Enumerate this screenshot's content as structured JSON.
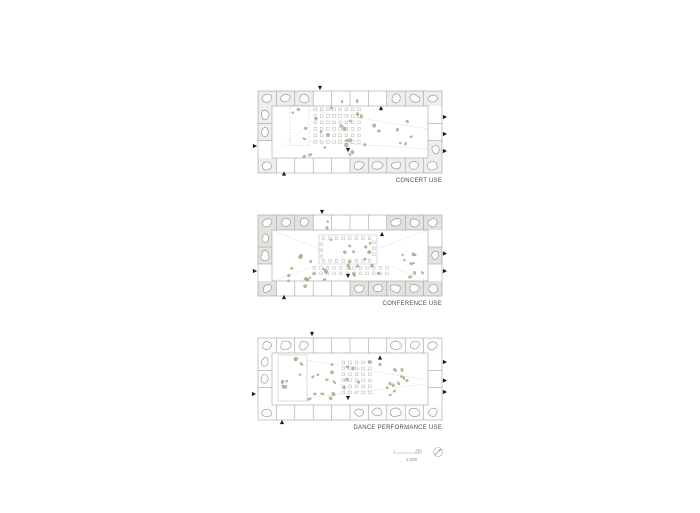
{
  "canvas": {
    "width": 700,
    "height": 513,
    "background": "#ffffff"
  },
  "colors": {
    "grid": "#9a9a9a",
    "grid_light": "#bdbdbd",
    "rock_stroke": "#8d8d8d",
    "rock_fill": "#fdfdfc",
    "figure_fill": "#b9ae8c",
    "figure_stroke": "#958b6a",
    "chair_stroke": "#aeaeae",
    "marker": "#1c1c1c",
    "label_text": "#4d4d4d",
    "sightline": "#e2e2e2",
    "footer_line": "#9f9f9f"
  },
  "plans": [
    {
      "name": "concert",
      "label": "CONCERT USE",
      "origin": {
        "x": 258,
        "y": 87
      },
      "size": {
        "w": 184,
        "h": 82
      },
      "band": {
        "top": 15,
        "bottom": 15,
        "left": 14,
        "right": 14
      },
      "top_cells": 10,
      "side_rows": 3,
      "cell_fill": "#efeeec",
      "rocks": {
        "top": [
          0,
          1,
          2,
          7,
          8,
          9
        ],
        "bottom": [
          0,
          5,
          6,
          7,
          8,
          9
        ],
        "left": [
          0,
          1
        ],
        "right": [
          2
        ]
      },
      "rects": [
        {
          "x": 32,
          "y": 14.5,
          "w": 19,
          "h": 40,
          "dash": true
        }
      ],
      "chair_grids": [
        {
          "x": 56,
          "y": 17,
          "cols": 8,
          "rows": 6,
          "dx": 6.2,
          "dy": 6.5,
          "size": 2.8
        }
      ],
      "figure_regions": [
        {
          "x": 34,
          "y": 17,
          "w": 15,
          "h": 35,
          "n": 4
        },
        {
          "x": 57,
          "y": 17,
          "w": 46,
          "h": 36,
          "n": 10
        },
        {
          "x": 102,
          "y": 24,
          "w": 54,
          "h": 36,
          "n": 9
        },
        {
          "x": 38,
          "y": 54,
          "w": 58,
          "h": 12,
          "n": 6
        },
        {
          "x": 80,
          "y": 2,
          "w": 20,
          "h": 11,
          "n": 2
        }
      ],
      "sight_lines": [
        [
          51,
          19,
          170,
          38
        ],
        [
          51,
          50,
          170,
          58
        ],
        [
          14,
          63,
          51,
          34
        ]
      ],
      "markers": [
        [
          "down",
          62,
          -3
        ],
        [
          "up",
          123,
          17
        ],
        [
          "down",
          90,
          59
        ],
        [
          "up",
          26,
          82.5
        ],
        [
          "right",
          -3,
          55
        ],
        [
          "right",
          187,
          26
        ],
        [
          "right",
          187,
          43
        ],
        [
          "right",
          187,
          60
        ]
      ]
    },
    {
      "name": "conference",
      "label": "CONFERENCE USE",
      "origin": {
        "x": 258,
        "y": 211
      },
      "size": {
        "w": 184,
        "h": 81
      },
      "band": {
        "top": 15,
        "bottom": 15,
        "left": 14,
        "right": 14
      },
      "top_cells": 10,
      "side_rows": 3,
      "cell_fill": "#e4e2df",
      "rocks": {
        "top": [
          0,
          1,
          2,
          7,
          8,
          9
        ],
        "bottom": [
          0,
          5,
          6,
          7,
          8,
          9
        ],
        "left": [
          0,
          1
        ],
        "right": [
          1
        ]
      },
      "rects": [
        {
          "x": 61,
          "y": 20,
          "w": 58,
          "h": 29,
          "dash": false
        }
      ],
      "chair_grids": [
        {
          "x": 64,
          "y": 22,
          "cols": 8,
          "rows": 1,
          "dx": 6.6,
          "dy": 6,
          "size": 2.6
        },
        {
          "x": 64,
          "y": 44.5,
          "cols": 8,
          "rows": 1,
          "dx": 6.6,
          "dy": 6,
          "size": 2.6
        },
        {
          "x": 62,
          "y": 28,
          "cols": 1,
          "rows": 3,
          "dx": 6,
          "dy": 6,
          "size": 2.6
        },
        {
          "x": 114.5,
          "y": 26,
          "cols": 1,
          "rows": 3,
          "dx": 6,
          "dy": 6,
          "size": 2.6
        },
        {
          "x": 55,
          "y": 51.5,
          "cols": 12,
          "rows": 2,
          "dx": 6.6,
          "dy": 5.5,
          "size": 2.6
        }
      ],
      "figure_regions": [
        {
          "x": 64,
          "y": 21,
          "w": 52,
          "h": 26,
          "n": 10
        },
        {
          "x": 25,
          "y": 38,
          "w": 30,
          "h": 28,
          "n": 8
        },
        {
          "x": 55,
          "y": 50,
          "w": 80,
          "h": 13,
          "n": 10
        },
        {
          "x": 135,
          "y": 38,
          "w": 30,
          "h": 26,
          "n": 9
        },
        {
          "x": 45,
          "y": 62,
          "w": 30,
          "h": 11,
          "n": 5
        },
        {
          "x": 68,
          "y": 2,
          "w": 12,
          "h": 11,
          "n": 2
        }
      ],
      "sight_lines": [
        [
          14,
          15,
          61,
          34
        ],
        [
          170,
          15,
          119,
          34
        ],
        [
          14,
          66,
          55,
          52
        ],
        [
          170,
          66,
          134,
          52
        ]
      ],
      "markers": [
        [
          "down",
          64,
          -3
        ],
        [
          "up",
          124,
          19
        ],
        [
          "down",
          90,
          61
        ],
        [
          "up",
          26,
          82
        ],
        [
          "right",
          -3,
          56
        ],
        [
          "right",
          187,
          38.5
        ],
        [
          "right",
          187,
          56
        ]
      ]
    },
    {
      "name": "dance",
      "label": "DANCE PERFORMANCE USE",
      "origin": {
        "x": 258,
        "y": 334
      },
      "size": {
        "w": 184,
        "h": 82
      },
      "band": {
        "top": 15,
        "bottom": 15,
        "left": 14,
        "right": 14
      },
      "top_cells": 10,
      "side_rows": 3,
      "cell_fill": "#fdfdfc",
      "rocks": {
        "top": [
          0,
          1,
          2,
          7,
          8,
          9
        ],
        "bottom": [
          0,
          5,
          6,
          7,
          8,
          9
        ],
        "left": [
          0,
          1
        ],
        "right": []
      },
      "rects": [
        {
          "x": 20,
          "y": 17,
          "w": 29,
          "h": 46,
          "dash": false
        }
      ],
      "chair_grids": [
        {
          "x": 84,
          "y": 23,
          "cols": 5,
          "rows": 6,
          "dx": 6.6,
          "dy": 6.0,
          "size": 2.8
        }
      ],
      "figure_regions": [
        {
          "x": 22,
          "y": 19,
          "w": 25,
          "h": 42,
          "n": 8
        },
        {
          "x": 50,
          "y": 20,
          "w": 32,
          "h": 42,
          "n": 11
        },
        {
          "x": 86,
          "y": 23,
          "w": 30,
          "h": 34,
          "n": 6
        },
        {
          "x": 120,
          "y": 22,
          "w": 32,
          "h": 36,
          "n": 12
        }
      ],
      "sight_lines": [
        [
          49,
          22,
          168,
          42
        ],
        [
          49,
          60,
          168,
          46
        ]
      ],
      "markers": [
        [
          "down",
          54,
          -4
        ],
        [
          "up",
          122,
          19.5
        ],
        [
          "down",
          90,
          60
        ],
        [
          "up",
          24,
          84
        ],
        [
          "right",
          -4,
          56
        ],
        [
          "right",
          187,
          24
        ],
        [
          "right",
          187,
          42.5
        ],
        [
          "right",
          187,
          54
        ]
      ]
    }
  ],
  "footer": {
    "scale_text": "1:200"
  }
}
